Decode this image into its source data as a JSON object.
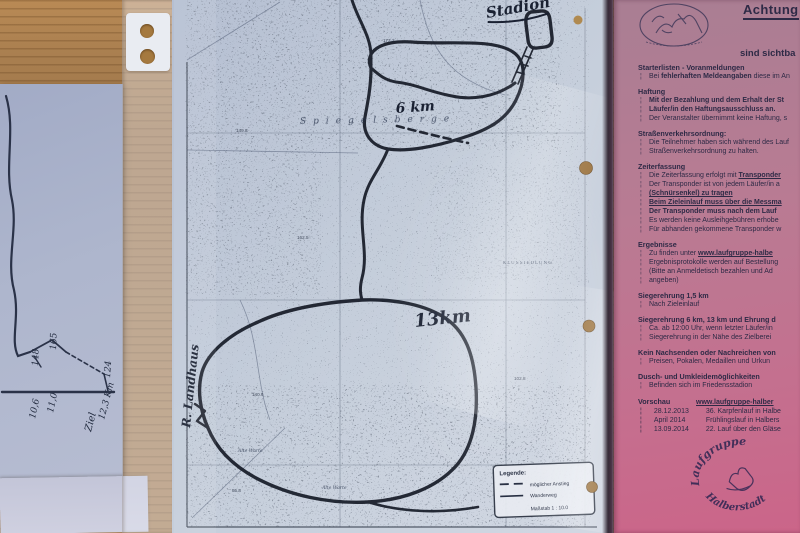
{
  "scene": {
    "description": "photo of a course map in a sheet protector beside a pink race-info sheet on a wooden table",
    "colors": {
      "wood": "#a87e4f",
      "map_paper": "#c4cddb",
      "pink_sheet": "#c4708f",
      "ink": "#1c2230"
    }
  },
  "sketch": {
    "numbers": [
      "148",
      "165",
      "124",
      "11,0",
      "10,6",
      "12,3 Km",
      "Ziel"
    ]
  },
  "map": {
    "handwritten": {
      "stadion": "Stadion",
      "km6": "6 km",
      "km13": "13km",
      "landhaus": "R. Landhaus"
    },
    "printed": {
      "ridge": "Spiegelsberge",
      "settlement": "KLUSSIEDLUNG",
      "warte1": "Alte Warte",
      "warte2": "Alte Warte"
    },
    "spot_heights": [
      "172.2",
      "162.5",
      "149.8",
      "140.6",
      "102.8",
      "95.8"
    ],
    "legend": {
      "title": "Legende:",
      "dashed": "möglicher Anstieg",
      "solid": "Wanderweg",
      "scale": "Maßstab 1 : 10.0"
    }
  },
  "pink": {
    "title": "Achtung",
    "subtitle": "sind sichtba",
    "bullet": "¦",
    "sections": [
      {
        "h": "Starterlisten - Voranmeldungen",
        "lines": [
          [
            {
              "t": "Bei "
            },
            {
              "t": "fehlerhaften Meldeangaben",
              "b": 1
            },
            {
              "t": " diese im An"
            }
          ]
        ]
      },
      {
        "h": "Haftung",
        "lines": [
          [
            {
              "t": "Mit der Bezahlung und dem Erhalt der St",
              "b": 1
            }
          ],
          [
            {
              "t": "Läufer/in den Haftungsausschluss an.",
              "b": 1
            }
          ],
          [
            {
              "t": "Der Veranstalter übernimmt keine Haftung, s"
            }
          ]
        ]
      },
      {
        "h": "Straßenverkehrsordnung:",
        "lines": [
          [
            {
              "t": "Die Teilnehmer haben sich während des Lauf"
            }
          ],
          [
            {
              "t": "Straßenverkehrsordnung zu halten."
            }
          ]
        ]
      },
      {
        "h": "Zeiterfassung",
        "lines": [
          [
            {
              "t": "Die Zeiterfassung erfolgt mit "
            },
            {
              "t": "Transponder",
              "b": 1,
              "u": 1
            }
          ],
          [
            {
              "t": "Der Transponder ist von jedem Läufer/in a"
            }
          ],
          [
            {
              "t": "(Schnürsenkel) zu tragen",
              "b": 1,
              "u": 1
            }
          ],
          [
            {
              "t": "Beim Zieleinlauf muss über die Messma",
              "b": 1,
              "u": 1
            }
          ],
          [
            {
              "t": "Der Transponder muss nach dem Lauf",
              "b": 1
            }
          ],
          [
            {
              "t": "Es werden keine Ausleihgebühren erhobe"
            }
          ],
          [
            {
              "t": "Für abhanden gekommene Transponder w"
            }
          ]
        ]
      },
      {
        "h": "Ergebnisse",
        "lines": [
          [
            {
              "t": "Zu finden unter "
            },
            {
              "t": "www.laufgruppe-halbe",
              "b": 1,
              "u": 1
            }
          ],
          [
            {
              "t": "Ergebnisprotokolle werden auf Bestellung"
            }
          ],
          [
            {
              "t": "(Bitte an Anmeldetisch bezahlen und Ad"
            }
          ],
          [
            {
              "t": "angeben)"
            }
          ]
        ]
      },
      {
        "h": "Siegerehrung 1,5 km",
        "lines": [
          [
            {
              "t": "Nach Zieleinlauf"
            }
          ]
        ]
      },
      {
        "h": "Siegerehrung 6 km, 13 km und Ehrung d",
        "lines": [
          [
            {
              "t": "Ca. ab 12:00 Uhr, wenn letzter Läufer/in"
            }
          ],
          [
            {
              "t": "Siegerehrung in der Nähe des Zielberei"
            }
          ]
        ]
      },
      {
        "h": "Kein Nachsenden oder Nachreichen von",
        "lines": [
          [
            {
              "t": "Preisen, Pokalen, Medaillen und Urkun"
            }
          ]
        ]
      },
      {
        "h": "Dusch- und Umkleidemöglichkeiten",
        "lines": [
          [
            {
              "t": "Befinden sich im Friedensstadion"
            }
          ]
        ]
      }
    ],
    "vorschau": {
      "heading": "Vorschau",
      "url": "www.laufgruppe-halber",
      "rows": [
        {
          "date": "28.12.2013",
          "event": "36. Karpfenlauf in Halbe"
        },
        {
          "date": "April 2014",
          "event": "Frühlingslauf in Halbers"
        },
        {
          "date": "13.09.2014",
          "event": "22. Lauf über den Gläse"
        }
      ]
    },
    "stamp": {
      "top": "Laufgruppe",
      "bottom": "Halberstadt"
    }
  }
}
